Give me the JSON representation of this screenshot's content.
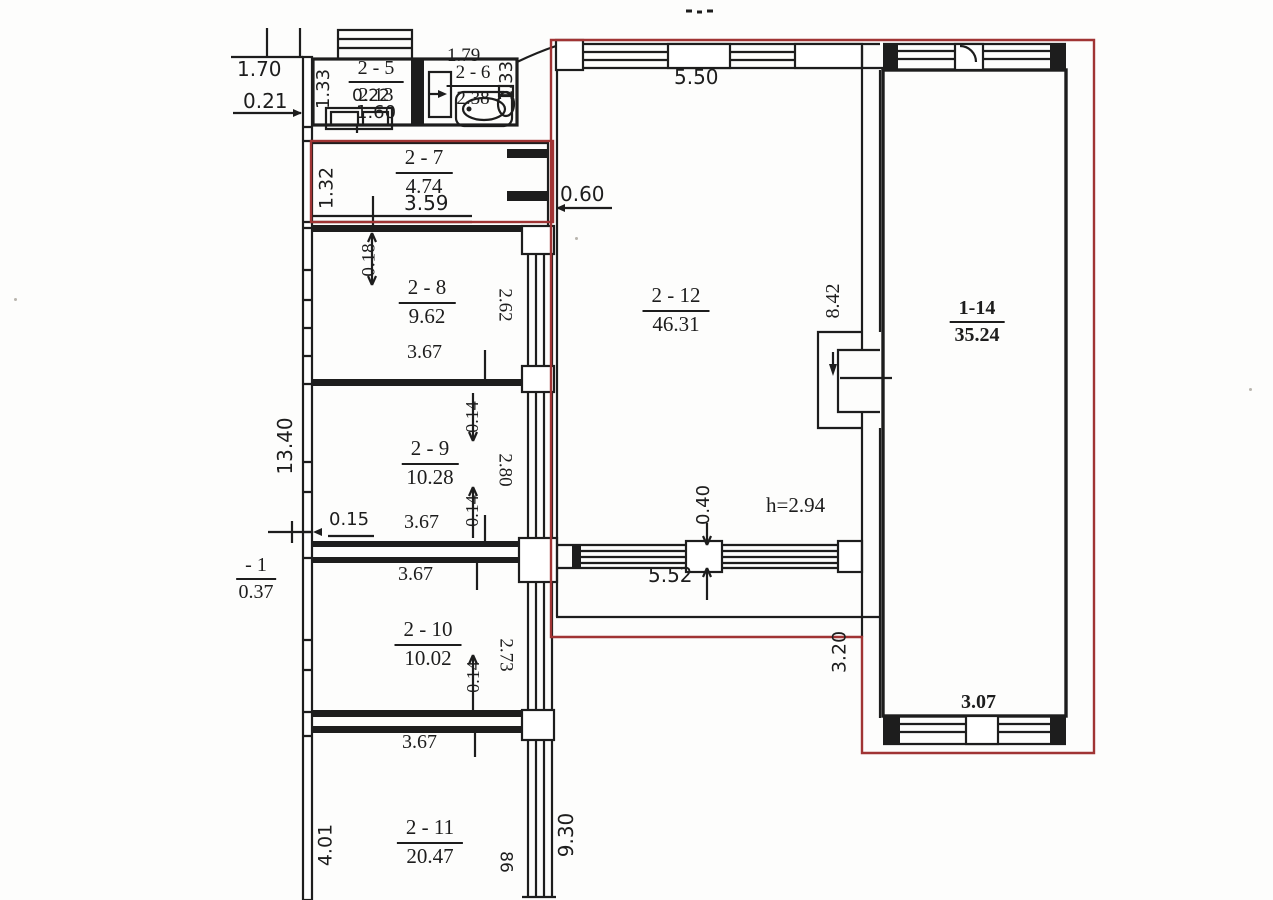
{
  "rooms": {
    "r2_5": {
      "number": "2 - 5",
      "area": "2.13"
    },
    "r2_6": {
      "number": "2 - 6",
      "area": "2.38"
    },
    "r2_7": {
      "number": "2 - 7",
      "area": "4.74"
    },
    "r2_8": {
      "number": "2 - 8",
      "area": "9.62"
    },
    "r2_9": {
      "number": "2 - 9",
      "area": "10.28"
    },
    "r2_10": {
      "number": "2 - 10",
      "area": "10.02"
    },
    "r2_11": {
      "number": "2 - 11",
      "area": "20.47"
    },
    "r2_12": {
      "number": "2 - 12",
      "area": "46.31"
    },
    "r1_14": {
      "number": "1-14",
      "area": "35.24"
    },
    "basement": {
      "number": "- 1",
      "area": "0.37"
    }
  },
  "dims": {
    "d170": "1.70",
    "d021": "0.21",
    "d133a": "1.33",
    "d022": "0.22",
    "d160": "1.60",
    "d179": "1.79",
    "d133b": "1.33",
    "d132": "1.32",
    "d359": "3.59",
    "d060": "0.60",
    "d018": "0.18",
    "d262": "2.62",
    "d367a": "3.67",
    "d1340": "13.40",
    "d014a": "0.14",
    "d280": "2.80",
    "d014b": "0.14",
    "d015": "0.15",
    "d367b": "3.67",
    "d367c": "3.67",
    "d273": "2.73",
    "d014c": "0.14",
    "d367d": "3.67",
    "d401": "4.01",
    "d930": "9.30",
    "d86": "86",
    "d550": "5.50",
    "d842": "8.42",
    "d040": "0.40",
    "h294": "h=2.94",
    "d552": "5.52",
    "d320": "3.20",
    "d307": "3.07"
  },
  "colors": {
    "line": "#1d1d1d",
    "boundary": "#a03434",
    "paper": "#fdfdfc"
  }
}
